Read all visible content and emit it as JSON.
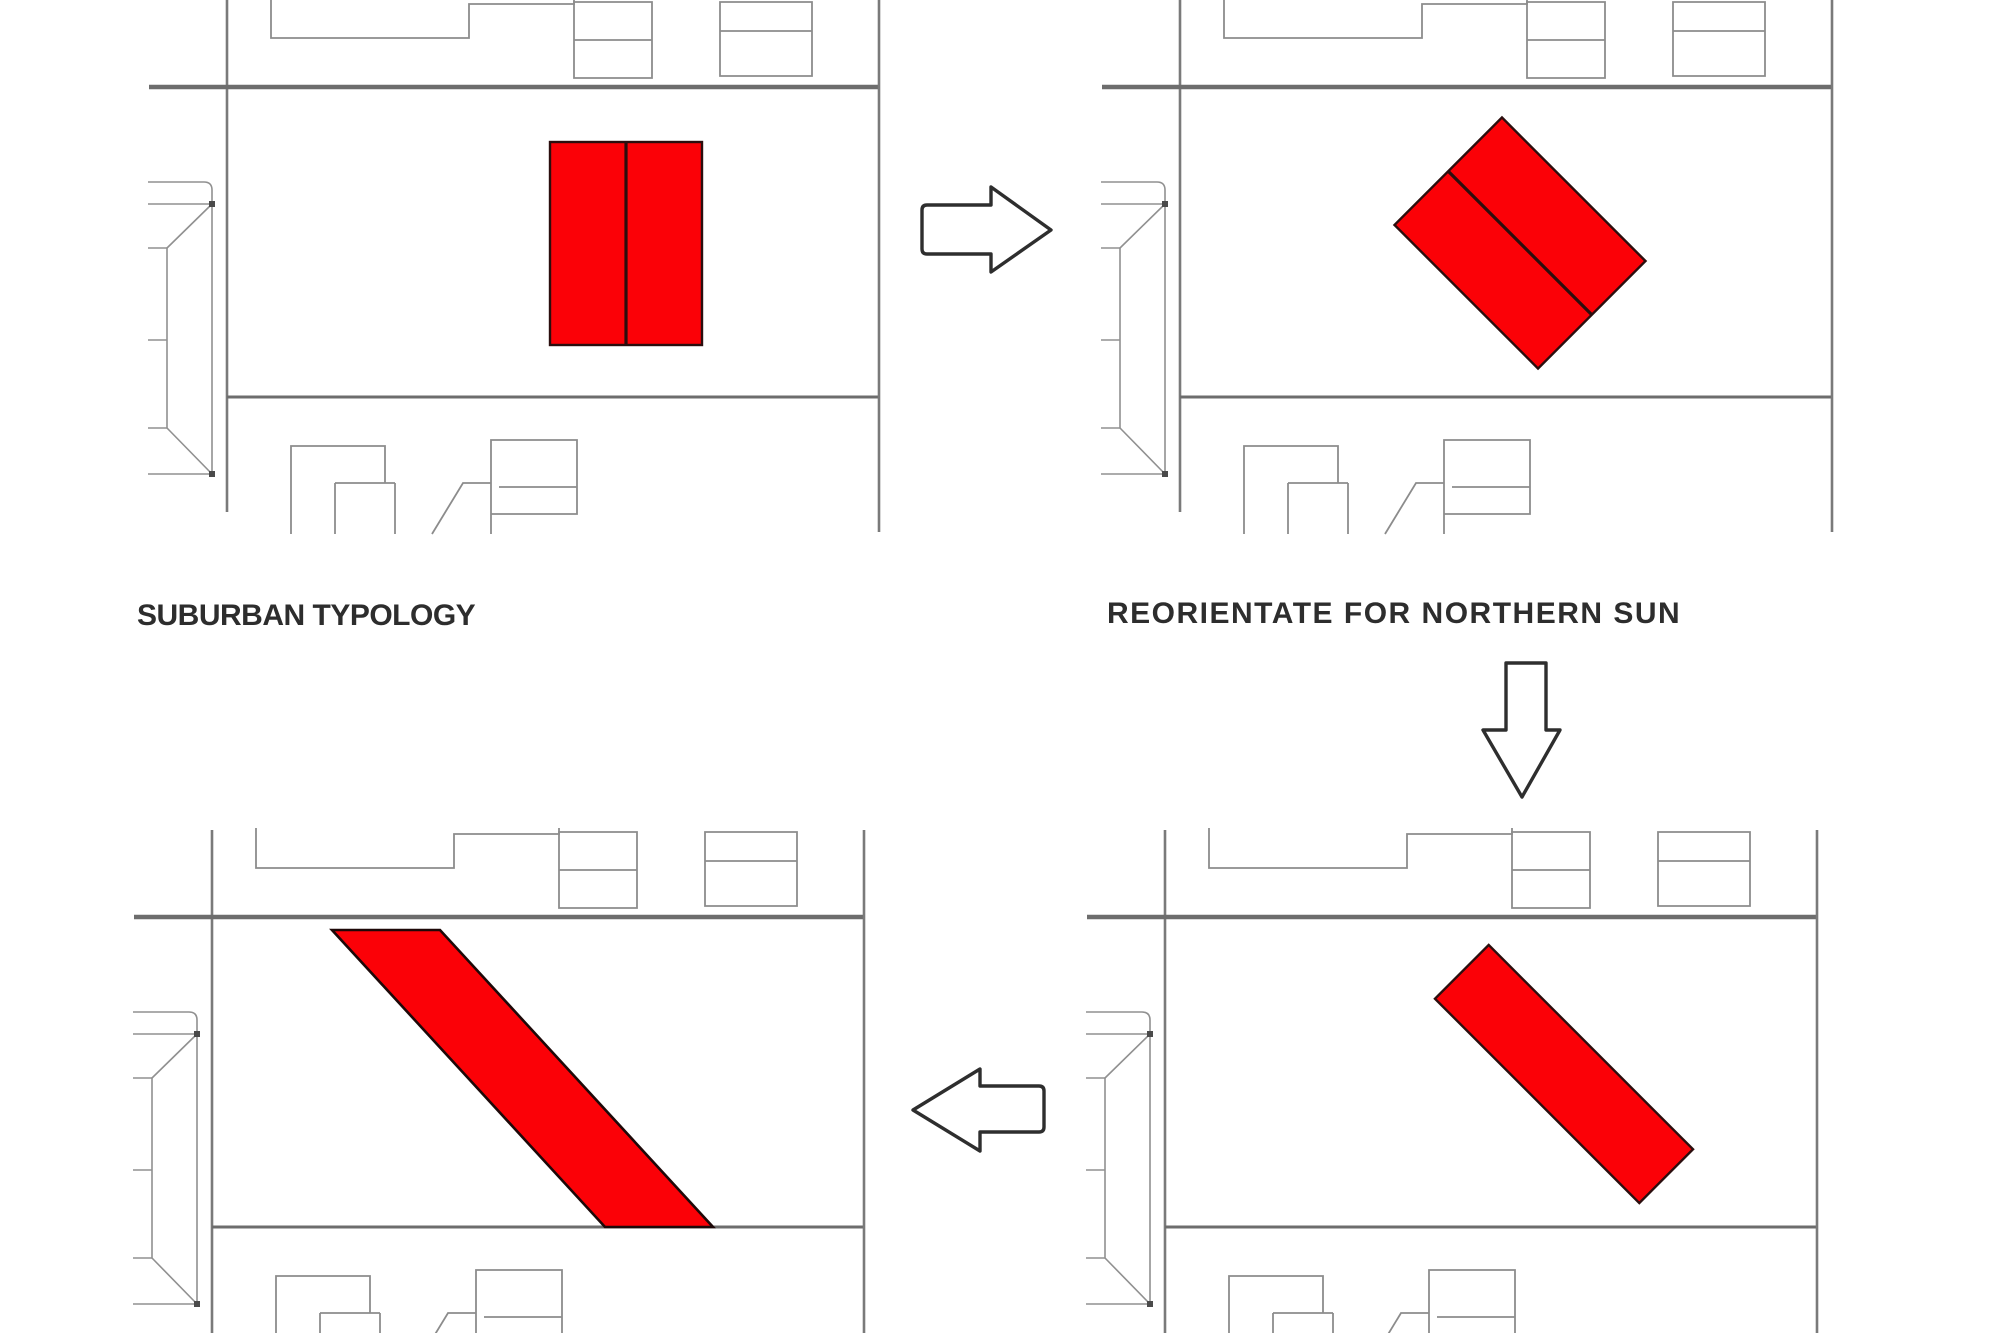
{
  "diagram": {
    "background": "#ffffff",
    "captions": {
      "suburban": "SUBURBAN TYPOLOGY",
      "reorientate": "REORIENTATE FOR NORTHERN SUN"
    },
    "colors": {
      "building_red": "#fb0107",
      "building_outline": "#2b0e0e",
      "linework_gray": "#8c8c8c",
      "street_gray": "#6d6d6d",
      "arrow_outline": "#2e2e2e",
      "caption_text": "#2d2d2d"
    },
    "panels": [
      {
        "id": "suburban-typology",
        "red_shape": "double-rectangle-vertical"
      },
      {
        "id": "reorientate-for-northern-sun",
        "red_shape": "double-rectangle-rotated-45"
      },
      {
        "id": "extended-diagonal-result",
        "red_shape": "long-parallelogram"
      },
      {
        "id": "thin-diagonal-bar",
        "red_shape": "thin-rectangle-rotated-45"
      }
    ],
    "arrows": [
      {
        "direction": "right",
        "from": "suburban-typology",
        "to": "reorientate-for-northern-sun"
      },
      {
        "direction": "down",
        "from": "reorientate-for-northern-sun",
        "to": "thin-diagonal-bar"
      },
      {
        "direction": "left",
        "from": "thin-diagonal-bar",
        "to": "extended-diagonal-result"
      }
    ]
  }
}
